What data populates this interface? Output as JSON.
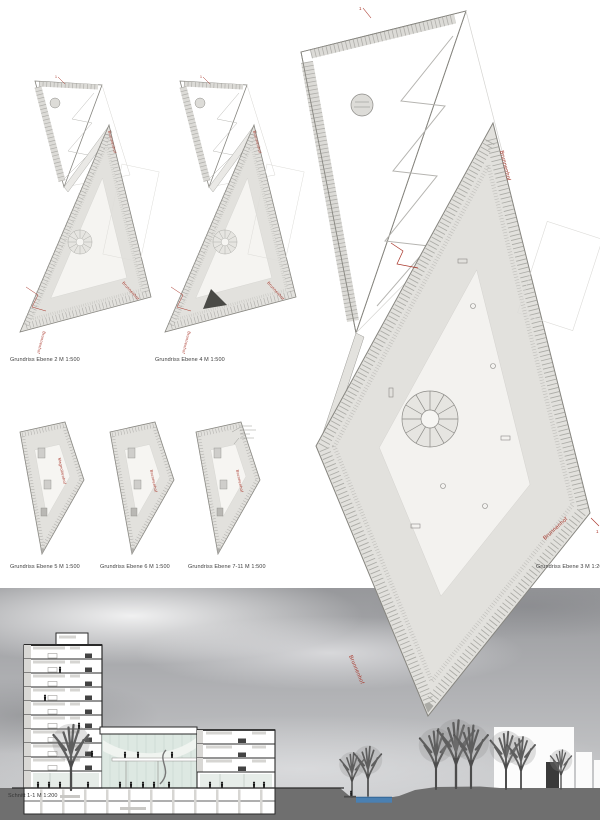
{
  "board_title": "Architekturprojekt Präsentationstafel",
  "captions": {
    "ebene2": "Grundriss Ebene 2 M 1:500",
    "ebene4": "Grundriss Ebene 4 M 1:500",
    "ebene5": "Grundriss Ebene 5 M 1:500",
    "ebene6": "Grundriss Ebene 6 M 1:500",
    "ebene7_11": "Grundriss Ebene 7-11 M 1:500",
    "ebene3": "Grundriss Ebene 3 M 1:200",
    "schnitt": "Schnitt 1-1 M 1:200"
  },
  "plan_labels": {
    "courtyard": "Brunnenhof",
    "garden": "Magnolienhof",
    "cut": "1"
  },
  "colors": {
    "accent_red": "#a83428",
    "plan_room_gray": "#e2e1dd",
    "plan_outline": "#86857f",
    "glass_green": "#dde8e2",
    "water_blue": "#4a80b2",
    "ground_gray": "#6f6f6f",
    "section_line": "#2a2a2a"
  }
}
